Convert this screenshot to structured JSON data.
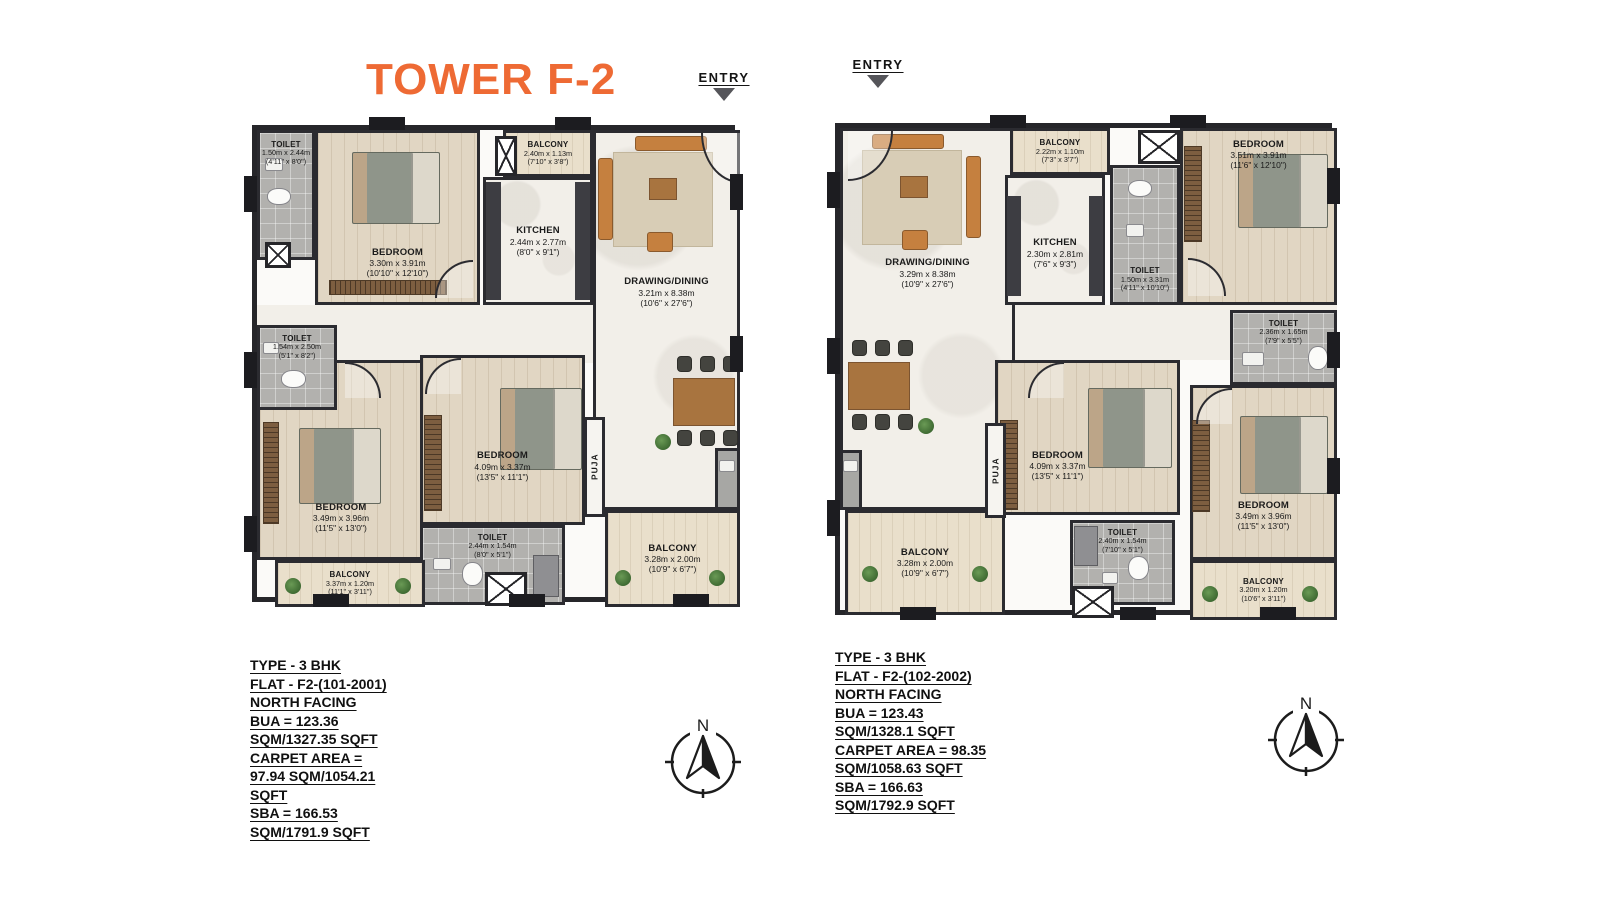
{
  "page": {
    "title": "TOWER F-2"
  },
  "colors": {
    "title": "#ee6a34",
    "wall": "#2b2b30"
  },
  "compass_label": "N",
  "plans": [
    {
      "entry_label": "ENTRY",
      "puja_label": "PUJA",
      "rooms": [
        {
          "name": "TOILET",
          "dim_m": "1.50m x 2.44m",
          "dim_ft": "(4'11\" x 8'0\")"
        },
        {
          "name": "BEDROOM",
          "dim_m": "3.30m x 3.91m",
          "dim_ft": "(10'10\" x 12'10\")"
        },
        {
          "name": "BALCONY",
          "dim_m": "2.40m x 1.13m",
          "dim_ft": "(7'10\" x 3'8\")"
        },
        {
          "name": "KITCHEN",
          "dim_m": "2.44m x 2.77m",
          "dim_ft": "(8'0\" x 9'1\")"
        },
        {
          "name": "DRAWING/DINING",
          "dim_m": "3.21m x 8.38m",
          "dim_ft": "(10'6\" x 27'6\")"
        },
        {
          "name": "TOILET",
          "dim_m": "1.54m x 2.50m",
          "dim_ft": "(5'1\" x 8'2\")"
        },
        {
          "name": "BEDROOM",
          "dim_m": "3.49m x 3.96m",
          "dim_ft": "(11'5\" x 13'0\")"
        },
        {
          "name": "BEDROOM",
          "dim_m": "4.09m x 3.37m",
          "dim_ft": "(13'5\" x 11'1\")"
        },
        {
          "name": "TOILET",
          "dim_m": "2.44m x 1.54m",
          "dim_ft": "(8'0\" x 5'1\")"
        },
        {
          "name": "BALCONY",
          "dim_m": "3.37m x 1.20m",
          "dim_ft": "(11'1\" x 3'11\")"
        },
        {
          "name": "BALCONY",
          "dim_m": "3.28m x 2.00m",
          "dim_ft": "(10'9\" x 6'7\")"
        }
      ],
      "info_lines": [
        "TYPE - 3 BHK",
        "FLAT - F2-(101-2001)",
        "NORTH FACING",
        "BUA = 123.36",
        "SQM/1327.35 SQFT",
        "CARPET AREA =",
        "97.94 SQM/1054.21",
        "SQFT",
        "SBA = 166.53",
        "SQM/1791.9 SQFT"
      ]
    },
    {
      "entry_label": "ENTRY",
      "puja_label": "PUJA",
      "rooms": [
        {
          "name": "DRAWING/DINING",
          "dim_m": "3.29m x 8.38m",
          "dim_ft": "(10'9\" x 27'6\")"
        },
        {
          "name": "BALCONY",
          "dim_m": "2.22m x 1.10m",
          "dim_ft": "(7'3\" x 3'7\")"
        },
        {
          "name": "KITCHEN",
          "dim_m": "2.30m x 2.81m",
          "dim_ft": "(7'6\" x 9'3\")"
        },
        {
          "name": "TOILET",
          "dim_m": "1.50m x 3.31m",
          "dim_ft": "(4'11\" x 10'10\")"
        },
        {
          "name": "BEDROOM",
          "dim_m": "3.51m x 3.91m",
          "dim_ft": "(11'6\" x 12'10\")"
        },
        {
          "name": "TOILET",
          "dim_m": "2.36m x 1.65m",
          "dim_ft": "(7'9\" x 5'5\")"
        },
        {
          "name": "BEDROOM",
          "dim_m": "4.09m x 3.37m",
          "dim_ft": "(13'5\" x 11'1\")"
        },
        {
          "name": "BEDROOM",
          "dim_m": "3.49m x 3.96m",
          "dim_ft": "(11'5\" x 13'0\")"
        },
        {
          "name": "BALCONY",
          "dim_m": "3.28m x 2.00m",
          "dim_ft": "(10'9\" x 6'7\")"
        },
        {
          "name": "TOILET",
          "dim_m": "2.40m x 1.54m",
          "dim_ft": "(7'10\" x 5'1\")"
        },
        {
          "name": "BALCONY",
          "dim_m": "3.20m x 1.20m",
          "dim_ft": "(10'6\" x 3'11\")"
        }
      ],
      "info_lines": [
        "TYPE - 3 BHK",
        "FLAT - F2-(102-2002)",
        "NORTH FACING",
        "BUA = 123.43",
        "SQM/1328.1 SQFT",
        "CARPET AREA = 98.35",
        "SQM/1058.63 SQFT",
        "SBA = 166.63",
        "SQM/1792.9 SQFT"
      ]
    }
  ]
}
